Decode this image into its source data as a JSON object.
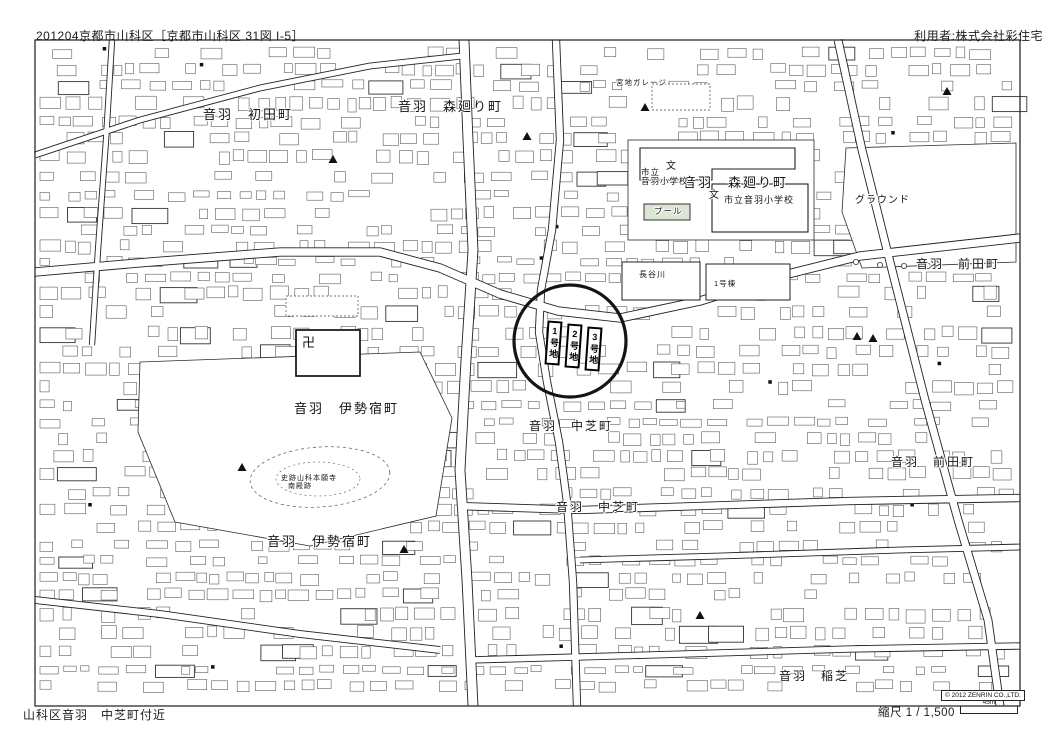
{
  "header": {
    "left": "201204京都市山科区［京都市山科区 31図 I-5］",
    "right": "利用者:株式会社彩住宅"
  },
  "footer": {
    "location": "山科区音羽　中芝町付近",
    "scale_label": "縮尺 1 / 1,500",
    "scale_bar_label": "45m"
  },
  "map": {
    "copyright": "© 2012 ZENRIN CO.,LTD.",
    "colors": {
      "line": "#222222",
      "building_outline": "#4f4f4f",
      "pool_fill": "#dce6d6",
      "paper": "#ffffff"
    },
    "target_circle": {
      "cx": 570,
      "cy": 341,
      "r": 56
    },
    "lots": [
      {
        "label": "1号地",
        "x": 546,
        "y": 321
      },
      {
        "label": "2号地",
        "x": 566,
        "y": 324
      },
      {
        "label": "3号地",
        "x": 586,
        "y": 327
      }
    ],
    "labels": [
      {
        "text": "音羽　初田町",
        "x": 203,
        "y": 108,
        "s": 13
      },
      {
        "text": "音羽　森廻り町",
        "x": 398,
        "y": 100,
        "s": 13
      },
      {
        "text": "音羽　森廻り町",
        "x": 683,
        "y": 176,
        "s": 13
      },
      {
        "text": "市立音羽小学校",
        "x": 724,
        "y": 196,
        "s": 9
      },
      {
        "text": "市立",
        "x": 641,
        "y": 168,
        "s": 8.5
      },
      {
        "text": "音羽小学校",
        "x": 641,
        "y": 177,
        "s": 8.5
      },
      {
        "text": "グラウンド",
        "x": 855,
        "y": 196,
        "s": 10
      },
      {
        "text": "音羽　前田町",
        "x": 916,
        "y": 258,
        "s": 12
      },
      {
        "text": "音羽　前田町",
        "x": 891,
        "y": 456,
        "s": 12
      },
      {
        "text": "音羽　伊勢宿町",
        "x": 294,
        "y": 402,
        "s": 13
      },
      {
        "text": "音羽　伊勢宿町",
        "x": 267,
        "y": 535,
        "s": 13
      },
      {
        "text": "音羽　中芝町",
        "x": 529,
        "y": 420,
        "s": 12
      },
      {
        "text": "音羽　中芝町",
        "x": 556,
        "y": 501,
        "s": 12
      },
      {
        "text": "音羽　稲芝",
        "x": 779,
        "y": 670,
        "s": 12
      },
      {
        "text": "史跡山科本願寺",
        "x": 281,
        "y": 475,
        "s": 7
      },
      {
        "text": "南殿跡",
        "x": 288,
        "y": 483,
        "s": 7
      },
      {
        "text": "長谷川",
        "x": 639,
        "y": 271,
        "s": 8
      },
      {
        "text": "1号棟",
        "x": 714,
        "y": 280,
        "s": 7.5
      },
      {
        "text": "宮地ガレージ",
        "x": 616,
        "y": 79,
        "s": 7.5
      },
      {
        "text": "プール",
        "x": 654,
        "y": 207,
        "s": 8.5
      }
    ],
    "symbols": {
      "school_glyph": "文",
      "temple_glyph": "卍",
      "school_marks": [
        {
          "x": 666,
          "y": 162
        },
        {
          "x": 709,
          "y": 191
        }
      ],
      "temple": {
        "x": 302,
        "y": 336
      },
      "survey_triangles": [
        [
          645,
          108
        ],
        [
          333,
          160
        ],
        [
          527,
          137
        ],
        [
          857,
          337
        ],
        [
          873,
          339
        ],
        [
          947,
          92
        ],
        [
          404,
          550
        ],
        [
          242,
          468
        ],
        [
          700,
          616
        ]
      ]
    }
  }
}
